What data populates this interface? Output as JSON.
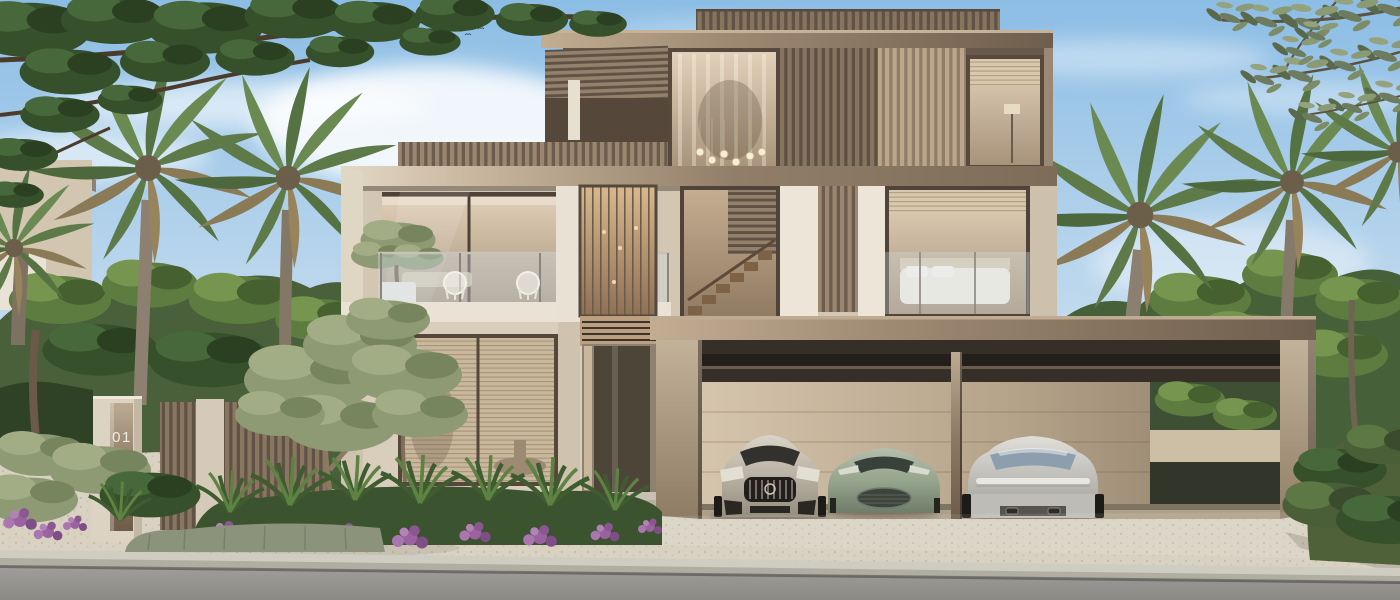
{
  "scene": {
    "type": "photorealistic architectural exterior rendering",
    "subject": "modern three-storey luxury villa with landscaped garden, palm trees and triple carport",
    "gate": {
      "unit_number": "01"
    },
    "vehicles": [
      "champagne sedan, front view",
      "sage green sports car, front view",
      "silver sedan, rear view"
    ]
  },
  "palette": {
    "sky_top": "#8cbde5",
    "sky_horizon": "#dfeaf4",
    "bronze_cladding": "#8d7c6b",
    "roof_fascia": "#8a7663",
    "stone_beige": "#d9cebc",
    "white_trim": "#eae3d5",
    "warm_glass": "#c9b69d",
    "door_brown": "#4e4539",
    "carport_wall": "#c6b59c",
    "paver": "#d9d2c2",
    "road": "#9a9996",
    "foliage_dark": "#35502a",
    "foliage_light": "#6d8a4f",
    "palm_green": "#5d7a48",
    "olive_green": "#93a07c",
    "flower_purple": "#9a63a0",
    "car_champagne": "#b9b1a3",
    "car_sage": "#98a690",
    "car_silver": "#c8c7c2"
  }
}
